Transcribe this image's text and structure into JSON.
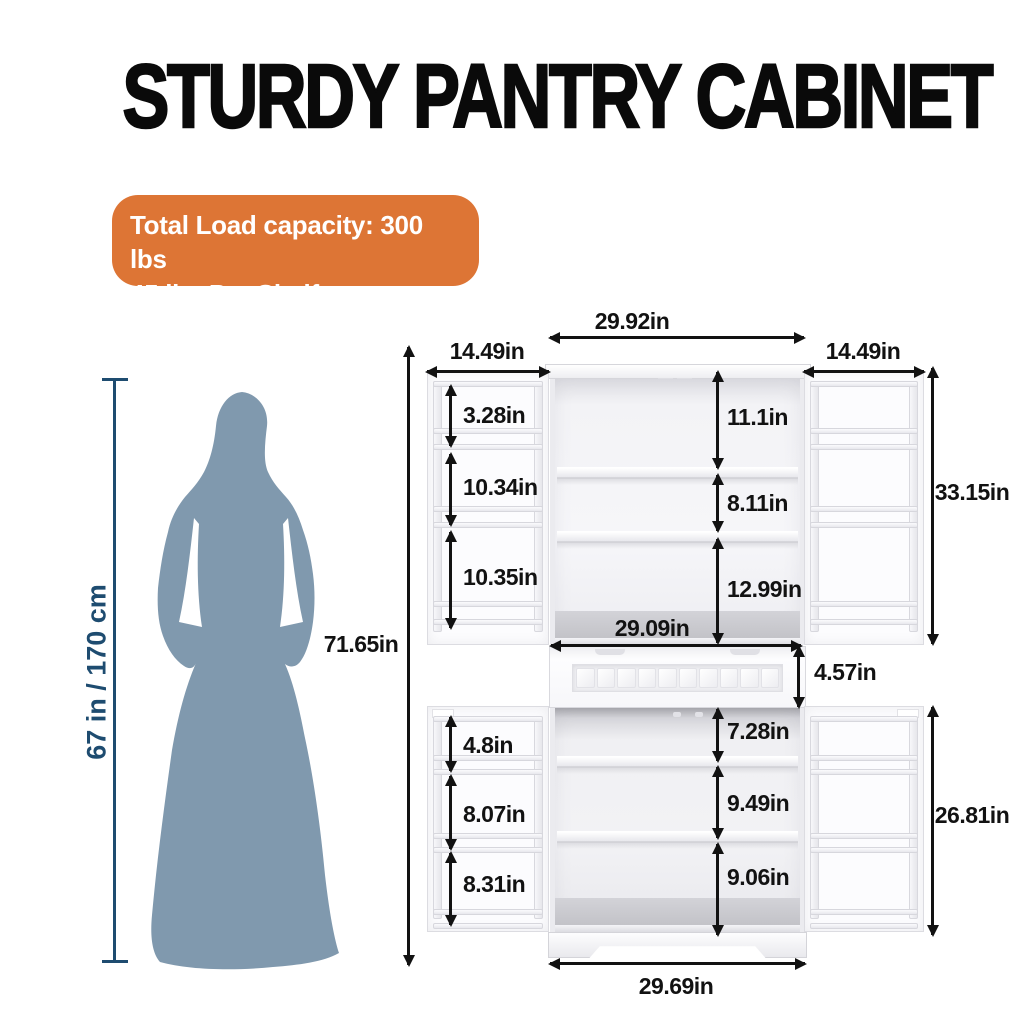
{
  "title": "STURDY PANTRY CABINET",
  "badge": {
    "line1": "Total Load capacity: 300 lbs",
    "line2": "45 lbs Per Shelf"
  },
  "person": {
    "height_label": "67 in / 170 cm"
  },
  "colors": {
    "badge_orange": "#DD7535",
    "silhouette_blue": "#8099AE",
    "height_navy": "#1E4C70",
    "dimension_black": "#121212"
  },
  "dims": {
    "top_width": "29.92in",
    "left_door_width": "14.49in",
    "right_door_width": "14.49in",
    "overall_height": "71.65in",
    "upper_section_height": "33.15in",
    "upper_door_pocket_1": "3.28in",
    "upper_door_pocket_2": "10.34in",
    "upper_door_pocket_3": "10.35in",
    "upper_shelf_space_1": "11.1in",
    "upper_shelf_space_2": "8.11in",
    "upper_shelf_space_3": "12.99in",
    "upper_interior_width": "29.09in",
    "middle_section_height": "4.57in",
    "lower_shelf_space_1": "7.28in",
    "lower_shelf_space_2": "9.49in",
    "lower_shelf_space_3": "9.06in",
    "lower_door_pocket_1": "4.8in",
    "lower_door_pocket_2": "8.07in",
    "lower_door_pocket_3": "8.31in",
    "lower_section_height": "26.81in",
    "base_width": "29.69in"
  }
}
